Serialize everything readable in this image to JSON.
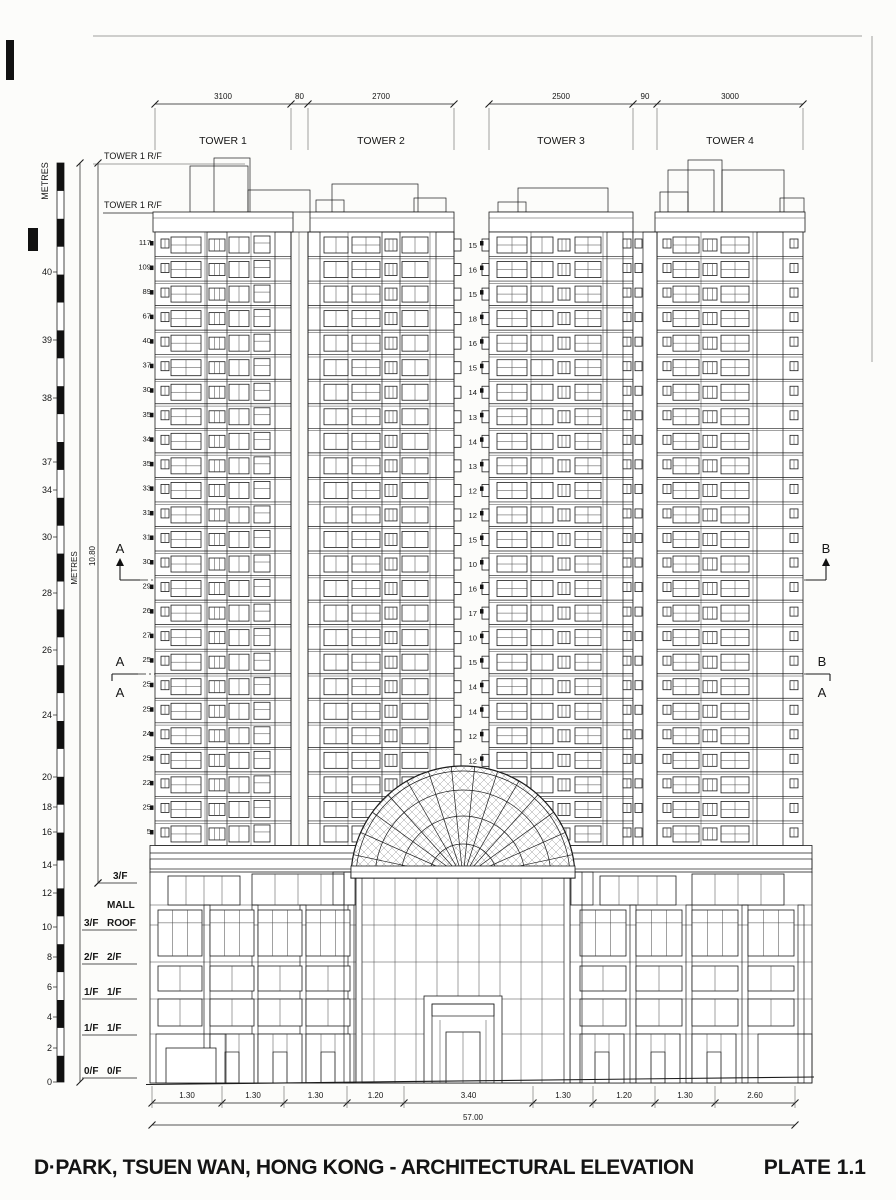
{
  "drawing": {
    "title": "D·PARK, TSUEN WAN, HONG KONG - ARCHITECTURAL ELEVATION",
    "plate": "PLATE 1.1"
  },
  "top_dimensions": {
    "left_group": [
      "3100",
      "80",
      "2700"
    ],
    "right_group": [
      "2500",
      "90",
      "3000"
    ]
  },
  "tower_labels": [
    "TOWER 1",
    "TOWER 2",
    "TOWER 3",
    "TOWER 4"
  ],
  "roof_labels": {
    "upper": "TOWER 1 R/F",
    "lower": "TOWER 1 R/F"
  },
  "vertical_scale": {
    "label": "METRES",
    "height_dim": "10.80",
    "ticks": [
      "40",
      "39",
      "38",
      "37",
      "34",
      "30",
      "28",
      "26",
      "24",
      "20",
      "18",
      "16",
      "14",
      "12",
      "10",
      "8",
      "6",
      "4",
      "2",
      "0"
    ]
  },
  "floor_dims_left": [
    "117",
    "109",
    "89",
    "67",
    "40",
    "37",
    "30",
    "35",
    "34",
    "35",
    "33",
    "31",
    "31",
    "30",
    "29",
    "26",
    "27",
    "25",
    "25",
    "25",
    "24",
    "25",
    "22",
    "25",
    "5"
  ],
  "floor_dims_right": [
    "15",
    "16",
    "15",
    "18",
    "16",
    "15",
    "14",
    "13",
    "14",
    "13",
    "12",
    "12",
    "15",
    "10",
    "16",
    "17",
    "10",
    "15",
    "14",
    "14",
    "12",
    "12"
  ],
  "section_markers": {
    "left_upper": "A",
    "left_lower": [
      "A",
      "A"
    ],
    "right_upper": "B",
    "right_lower": [
      "B",
      "A"
    ]
  },
  "podium_levels": {
    "top_right": "3/F",
    "mall": {
      "line1": "MALL",
      "left": "3/F",
      "line2": "ROOF"
    },
    "rows": [
      [
        "2/F",
        "2/F"
      ],
      [
        "1/F",
        "1/F"
      ],
      [
        "1/F",
        "1/F"
      ],
      [
        "0/F",
        "0/F"
      ]
    ]
  },
  "bottom_dimensions": {
    "segments": [
      "1.30",
      "1.30",
      "1.30",
      "1.20",
      "3.40",
      "1.30",
      "1.20",
      "1.30",
      "2.60"
    ],
    "total": "57.00"
  }
}
